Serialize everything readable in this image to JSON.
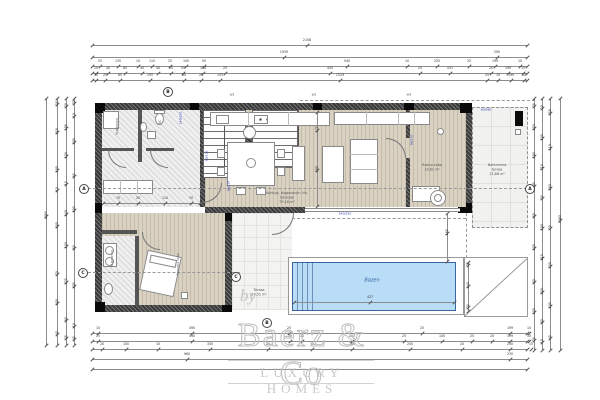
{
  "watermark": {
    "by": "by",
    "brand": "Baerz & Co",
    "tagline": "LUXURY HOMES"
  },
  "rooms": [
    {
      "x": 287,
      "y": 191,
      "w": 100,
      "lines": [
        "Kuhinja, blagovanje i dn. boravak",
        "79,18 m²"
      ]
    },
    {
      "x": 432,
      "y": 163,
      "w": 60,
      "lines": [
        "Radna soba",
        "13,81 m²"
      ]
    },
    {
      "x": 497,
      "y": 163,
      "w": 60,
      "lines": [
        "Natkrivena terasa",
        "13,88 m²"
      ]
    },
    {
      "x": 259,
      "y": 288,
      "w": 50,
      "lines": [
        "Terasa",
        "24,51 m²"
      ]
    },
    {
      "x": 372,
      "y": 277,
      "w": 60,
      "cls": "pool",
      "lines": [
        "Bazen"
      ]
    }
  ],
  "vlabels": [
    {
      "x": 117,
      "y": 126,
      "t": "Kupaonica"
    },
    {
      "x": 160,
      "y": 122,
      "t": "WC"
    },
    {
      "x": 112,
      "y": 258,
      "t": "Kupaonica"
    },
    {
      "x": 178,
      "y": 264,
      "t": "Spavaća soba"
    }
  ],
  "codes": [
    {
      "x": 181,
      "y": 118,
      "t": "240/250",
      "v": 1
    },
    {
      "x": 207,
      "y": 156,
      "t": "90/210",
      "v": 1
    },
    {
      "x": 229,
      "y": 186,
      "t": "80/210",
      "v": 1
    },
    {
      "x": 412,
      "y": 140,
      "t": "90/210",
      "v": 1
    },
    {
      "x": 486,
      "y": 110,
      "t": "60/060",
      "v": 0
    },
    {
      "x": 345,
      "y": 214,
      "t": "540/250",
      "v": 0
    },
    {
      "x": 232,
      "y": 95,
      "t": "W1",
      "v": 0,
      "g": 1
    },
    {
      "x": 314,
      "y": 95,
      "t": "W2",
      "v": 0,
      "g": 1
    },
    {
      "x": 409,
      "y": 95,
      "t": "W3",
      "v": 0,
      "g": 1
    }
  ],
  "markers": [
    {
      "x": 82,
      "y": 187,
      "t": "A"
    },
    {
      "x": 528,
      "y": 187,
      "t": "A"
    },
    {
      "x": 81,
      "y": 271,
      "t": "C"
    },
    {
      "x": 234,
      "y": 275,
      "t": "C"
    },
    {
      "x": 166,
      "y": 90,
      "t": "B"
    },
    {
      "x": 265,
      "y": 321,
      "t": "B"
    }
  ],
  "dimensions": [
    {
      "o": "h",
      "x": 92,
      "y": 45,
      "l": 435,
      "t": [
        [
          215,
          "2108"
        ]
      ]
    },
    {
      "o": "h",
      "x": 92,
      "y": 57,
      "l": 435,
      "t": [
        [
          192,
          "1939"
        ],
        [
          405,
          "290"
        ]
      ]
    },
    {
      "o": "h",
      "x": 92,
      "y": 66,
      "l": 435,
      "t": [
        [
          8,
          "25"
        ],
        [
          26,
          "135"
        ],
        [
          46,
          "10"
        ],
        [
          60,
          "110"
        ],
        [
          78,
          "25"
        ],
        [
          94,
          "100"
        ],
        [
          112,
          "50"
        ],
        [
          255,
          "540"
        ],
        [
          315,
          "10"
        ],
        [
          345,
          "255"
        ],
        [
          377,
          "25"
        ],
        [
          403,
          "199"
        ],
        [
          428,
          "10"
        ]
      ]
    },
    {
      "o": "h",
      "x": 92,
      "y": 73,
      "l": 435,
      "t": [
        [
          4,
          "10"
        ],
        [
          16,
          "40"
        ],
        [
          33,
          "80"
        ],
        [
          50,
          "40"
        ],
        [
          66,
          "40"
        ],
        [
          79,
          "15"
        ],
        [
          91,
          "55"
        ],
        [
          111,
          "150"
        ],
        [
          133,
          "25"
        ],
        [
          238,
          "445"
        ],
        [
          328,
          "25"
        ],
        [
          358,
          "531"
        ],
        [
          399,
          "20"
        ],
        [
          416,
          "199"
        ],
        [
          431,
          "15"
        ]
      ]
    },
    {
      "o": "h",
      "x": 92,
      "y": 80,
      "l": 435,
      "t": [
        [
          4,
          "10"
        ],
        [
          13,
          "25"
        ],
        [
          28,
          "60"
        ],
        [
          58,
          "255"
        ],
        [
          92,
          "60"
        ],
        [
          109,
          "25"
        ],
        [
          128,
          "155"
        ],
        [
          248,
          "1529"
        ],
        [
          395,
          "25"
        ],
        [
          406,
          "10"
        ],
        [
          419,
          "199"
        ],
        [
          432,
          "10"
        ]
      ]
    },
    {
      "o": "h",
      "x": 92,
      "y": 333,
      "l": 435,
      "t": [
        [
          6,
          "10"
        ],
        [
          100,
          "490"
        ],
        [
          197,
          "25"
        ],
        [
          330,
          "25"
        ],
        [
          418,
          "199"
        ],
        [
          437,
          "15"
        ]
      ]
    },
    {
      "o": "h",
      "x": 92,
      "y": 341,
      "l": 435,
      "t": [
        [
          6,
          "25"
        ],
        [
          100,
          "490"
        ],
        [
          198,
          "20"
        ],
        [
          210,
          "10"
        ],
        [
          260,
          "203"
        ],
        [
          312,
          "25"
        ],
        [
          350,
          "100"
        ],
        [
          380,
          "25"
        ],
        [
          400,
          "20"
        ],
        [
          418,
          "199"
        ],
        [
          437,
          "10"
        ]
      ]
    },
    {
      "o": "h",
      "x": 92,
      "y": 349,
      "l": 435,
      "t": [
        [
          10,
          "20"
        ],
        [
          34,
          "150"
        ],
        [
          66,
          "10"
        ],
        [
          118,
          "330"
        ],
        [
          176,
          "25"
        ],
        [
          220,
          "10"
        ],
        [
          260,
          "255"
        ],
        [
          318,
          "250"
        ],
        [
          370,
          "20"
        ],
        [
          418,
          "230"
        ],
        [
          439,
          "15"
        ]
      ]
    },
    {
      "o": "h",
      "x": 92,
      "y": 359,
      "l": 435,
      "t": [
        [
          95,
          "960"
        ],
        [
          418,
          "230"
        ]
      ]
    },
    {
      "o": "h",
      "x": 92,
      "y": 369,
      "l": 435,
      "t": []
    },
    {
      "o": "v",
      "x": 46,
      "y": 98,
      "l": 247,
      "t": [
        [
          118,
          "1085"
        ]
      ]
    },
    {
      "o": "v",
      "x": 57,
      "y": 98,
      "l": 247,
      "t": [
        [
          6,
          "25"
        ],
        [
          34,
          "250"
        ],
        [
          72,
          "190"
        ],
        [
          92,
          "10"
        ],
        [
          128,
          "500"
        ],
        [
          176,
          "70"
        ],
        [
          205,
          "400"
        ],
        [
          236,
          "45"
        ]
      ]
    },
    {
      "o": "v",
      "x": 66,
      "y": 98,
      "l": 247,
      "t": [
        [
          8,
          "20"
        ],
        [
          30,
          "198"
        ],
        [
          58,
          "100"
        ],
        [
          86,
          "15"
        ],
        [
          116,
          "240"
        ],
        [
          148,
          "130"
        ],
        [
          184,
          "375"
        ],
        [
          222,
          "60"
        ],
        [
          240,
          "25"
        ]
      ]
    },
    {
      "o": "v",
      "x": 74,
      "y": 98,
      "l": 247,
      "t": [
        [
          5,
          "25"
        ],
        [
          18,
          "10"
        ],
        [
          44,
          "205"
        ],
        [
          78,
          "85"
        ],
        [
          112,
          "500"
        ],
        [
          150,
          "50"
        ],
        [
          188,
          "405"
        ],
        [
          228,
          "10"
        ],
        [
          241,
          "45"
        ]
      ]
    },
    {
      "o": "v",
      "x": 534,
      "y": 98,
      "l": 252,
      "t": [
        [
          8,
          "25"
        ],
        [
          30,
          "250"
        ],
        [
          58,
          "190"
        ],
        [
          88,
          "300"
        ],
        [
          118,
          "50"
        ],
        [
          150,
          "500"
        ],
        [
          184,
          "50"
        ],
        [
          214,
          "400"
        ],
        [
          242,
          "25"
        ]
      ]
    },
    {
      "o": "v",
      "x": 542,
      "y": 98,
      "l": 252,
      "t": [
        [
          10,
          "20"
        ],
        [
          40,
          "150"
        ],
        [
          70,
          "710"
        ],
        [
          100,
          "25"
        ],
        [
          130,
          "100"
        ],
        [
          160,
          "210"
        ],
        [
          194,
          "300"
        ],
        [
          224,
          "50"
        ],
        [
          244,
          "10"
        ]
      ]
    },
    {
      "o": "v",
      "x": 550,
      "y": 98,
      "l": 252,
      "t": [
        [
          15,
          "250"
        ],
        [
          50,
          "110"
        ],
        [
          90,
          "680"
        ],
        [
          130,
          "25"
        ],
        [
          168,
          "550"
        ],
        [
          208,
          "100"
        ],
        [
          240,
          "45"
        ]
      ]
    },
    {
      "o": "v",
      "x": 560,
      "y": 98,
      "l": 252,
      "t": [
        [
          122,
          "1060"
        ]
      ]
    },
    {
      "o": "v",
      "x": 468,
      "y": 262,
      "l": 49,
      "t": [
        [
          3,
          "25"
        ],
        [
          24,
          "240"
        ],
        [
          45,
          "25"
        ]
      ]
    },
    {
      "o": "v",
      "x": 447,
      "y": 213,
      "l": 48,
      "t": [
        [
          20,
          "165"
        ]
      ]
    },
    {
      "o": "v",
      "x": 317,
      "y": 112,
      "l": 94,
      "t": [
        [
          18,
          "175"
        ],
        [
          58,
          "290"
        ]
      ]
    },
    {
      "o": "h",
      "x": 103,
      "y": 203,
      "l": 97,
      "t": [
        [
          15,
          "70"
        ],
        [
          35,
          "20"
        ],
        [
          62,
          "110"
        ],
        [
          88,
          "70"
        ]
      ]
    },
    {
      "o": "h",
      "x": 294,
      "y": 302,
      "l": 160,
      "t": [
        [
          76,
          "427"
        ]
      ]
    }
  ]
}
